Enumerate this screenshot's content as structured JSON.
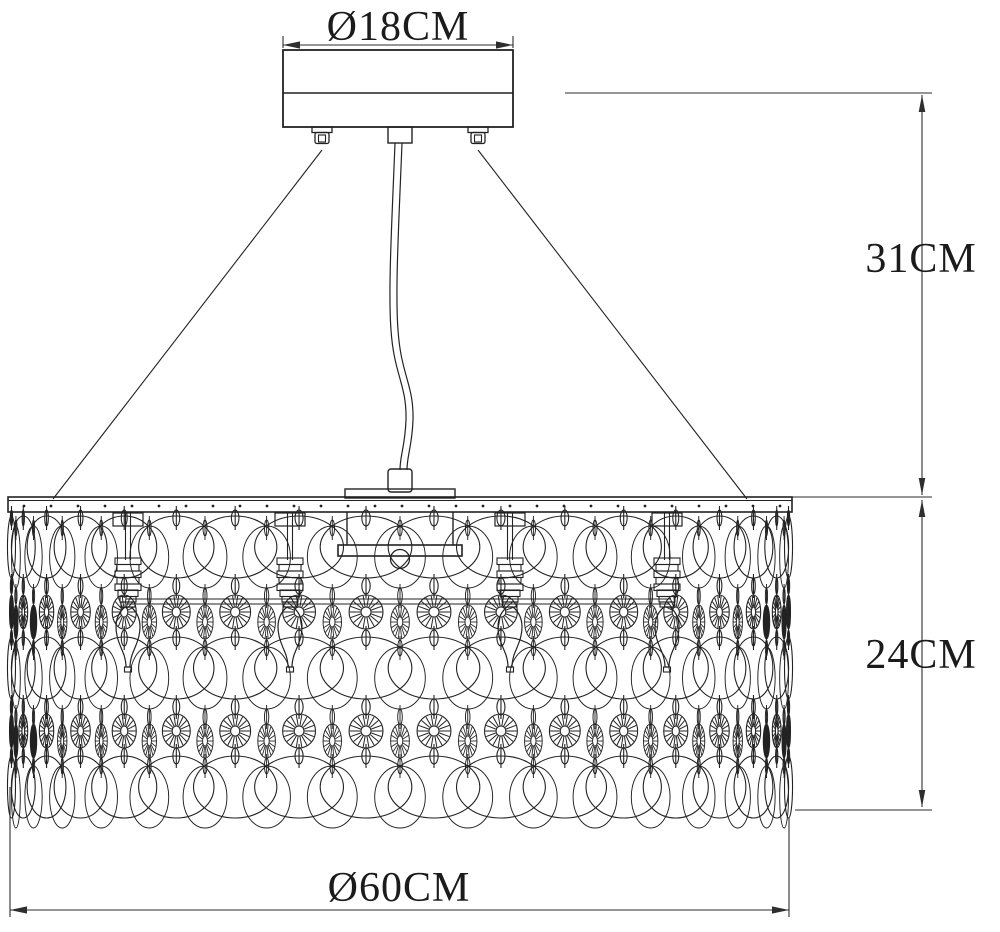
{
  "drawing": {
    "background": "#ffffff",
    "line_color": "#222222",
    "dim_color": "#2e2e2e",
    "dimensions": {
      "canopy_diameter": {
        "label": "Ø18CM"
      },
      "suspension_height": {
        "label": "31CM"
      },
      "shade_height": {
        "label": "24CM"
      },
      "shade_diameter": {
        "label": "Ø60CM"
      }
    }
  },
  "figure": {
    "bolts_x": [
      322,
      478
    ],
    "bulbs_x": [
      128,
      290,
      510,
      667
    ],
    "strands": {
      "count": 18,
      "cx": 400,
      "radius": 390,
      "link_cy": [
        518,
        586,
        638,
        707,
        756
      ],
      "link_rx": 4.2,
      "link_ry": 8,
      "disc_cy": [
        547,
        668,
        787
      ],
      "disc_rx": 46,
      "disc_ry": 31,
      "star_cy": [
        612,
        731
      ],
      "star_r": 17,
      "star_spokes": 18,
      "back_dy": 10,
      "back_squeeze": 0.55
    },
    "rim": {
      "x1": 8,
      "x2": 792,
      "dot_y": 506,
      "dot_step": 27,
      "dot_r": 1.4
    }
  }
}
